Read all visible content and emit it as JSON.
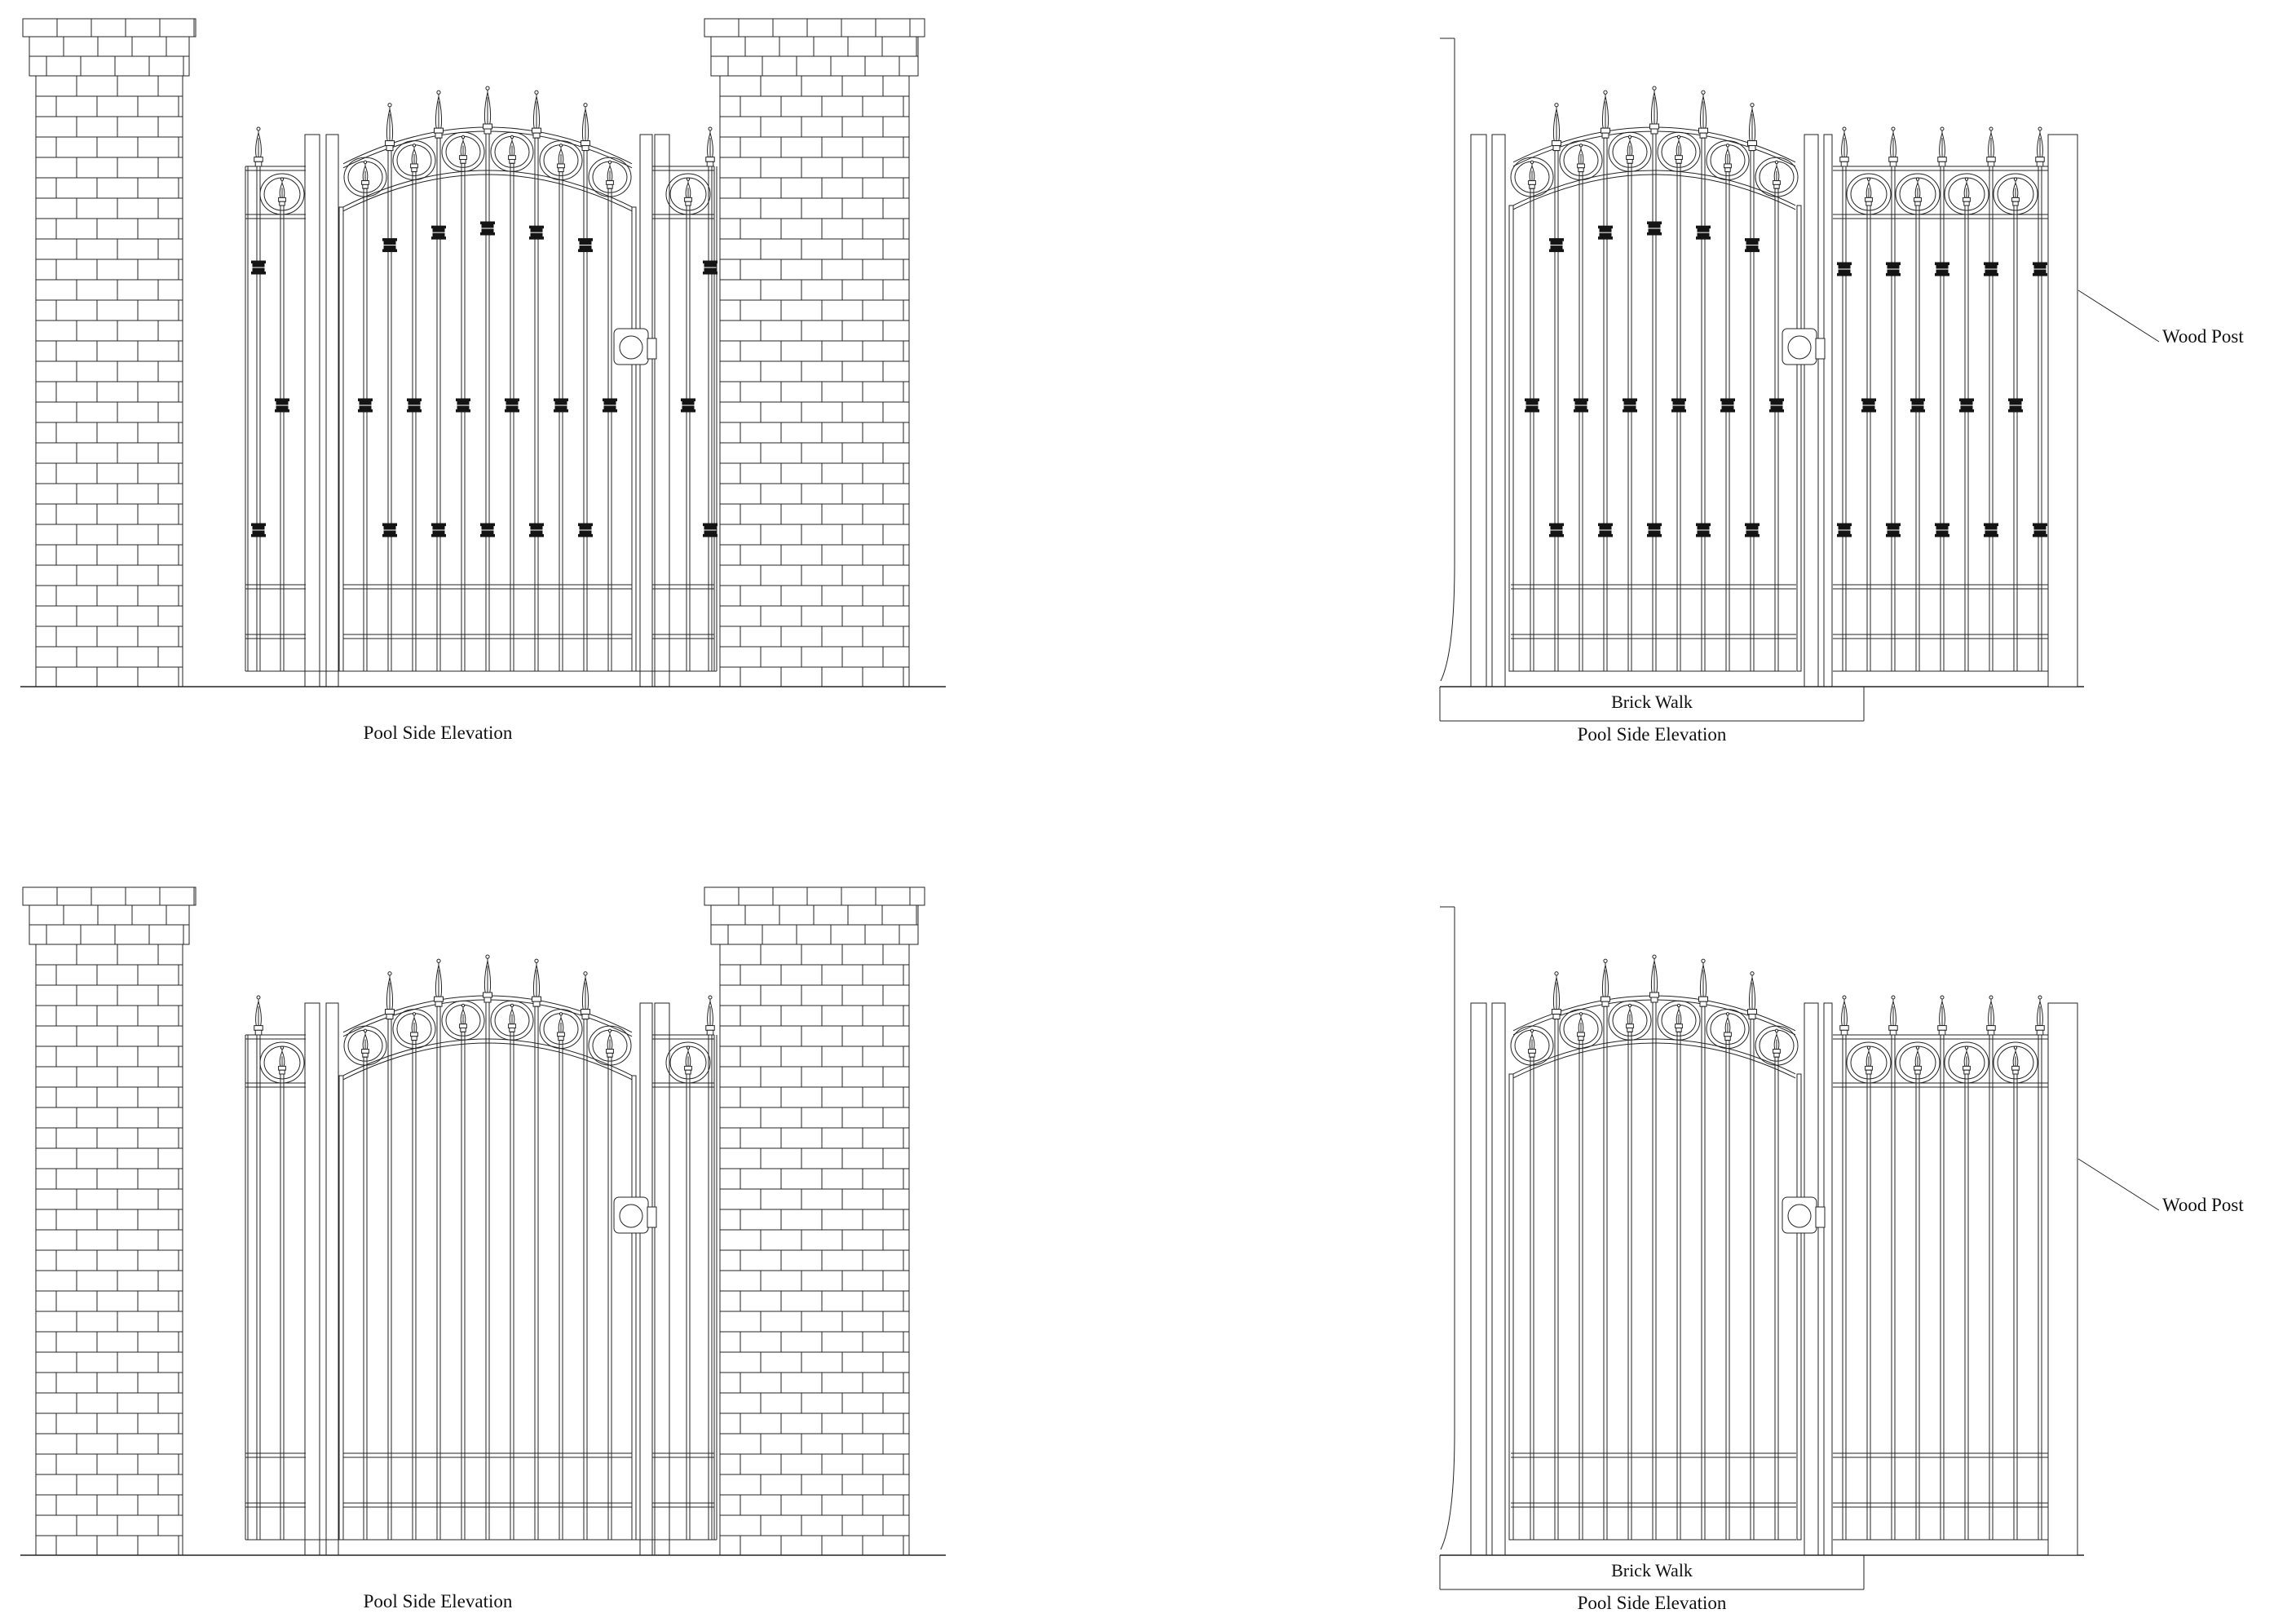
{
  "page": {
    "background": "#ffffff",
    "line_color": "#232323",
    "collar_color": "#141414",
    "text_color": "#101010"
  },
  "views": {
    "top_left": {
      "caption": "Pool Side Elevation"
    },
    "top_right": {
      "caption": "Pool Side Elevation",
      "walk": "Brick Walk",
      "post": "Wood Post"
    },
    "bottom_left": {
      "caption": "Pool Side Elevation"
    },
    "bottom_right": {
      "caption": "Pool Side Elevation",
      "walk": "Brick Walk",
      "post": "Wood Post"
    }
  }
}
